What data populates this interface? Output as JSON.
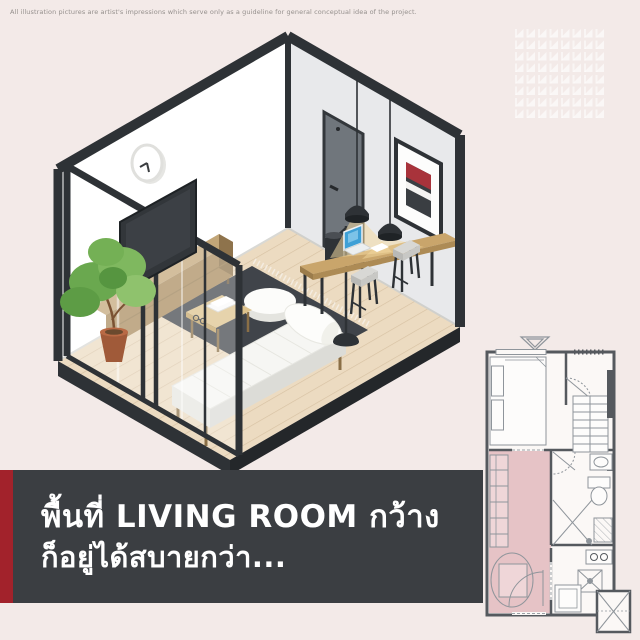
{
  "disclaimer": "All illustration pictures are artist's impressions which serve only as a guideline for general conceptual idea of the project.",
  "banner": {
    "line1": "พื้นที่ LIVING ROOM กว้าง",
    "line2": "ก็อยู่ได้สบายกว่า...",
    "background": "#3b3e42",
    "accent_stripe": "#a2222b",
    "text_color": "#ffffff"
  },
  "illustration": {
    "type": "isometric-room-cutaway",
    "room": "living room",
    "items": [
      "wall-clock",
      "glass-partition",
      "tv-panel",
      "sideboard",
      "potted-plant",
      "wood-plank-floor",
      "dark-rug",
      "round-pouf",
      "coffee-table-with-books",
      "daybed-with-bolster",
      "floor-lamp",
      "wall-desk",
      "laptop",
      "bar-stools",
      "pendant-lamps",
      "interior-door",
      "framed-artwork"
    ],
    "palette": {
      "left_wall": "#ffffff",
      "right_wall": "#e8e9eb",
      "frame_black": "#2e3236",
      "floor_wood": "#ecdbc1",
      "rug": "#40444a",
      "wood_furniture": "#c9a56b",
      "artwork_red": "#a8333b",
      "plant_green": "#6aa84f"
    }
  },
  "floor_plan": {
    "highlighted_room": "living room",
    "highlight_color": "#e6c3c6",
    "wall_color": "#55595e",
    "rooms": [
      "bedroom",
      "wardrobe",
      "bathroom",
      "living room",
      "kitchen",
      "balcony"
    ]
  }
}
